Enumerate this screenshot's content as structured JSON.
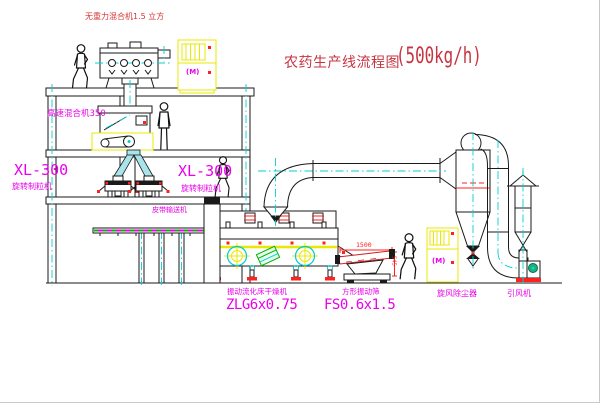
{
  "title": {
    "name": "农药生产线流程图",
    "capacity": "(500kg/h)"
  },
  "equipment_labels": {
    "gravity_mixer": "无重力混合机1.5 立方",
    "high_speed_mixer": "高速混合机350",
    "granulator_left": {
      "model": "XL-300",
      "name": "旋转制粒机"
    },
    "granulator_right": {
      "model": "XL-300",
      "name": "旋转制粒机"
    },
    "belt_conveyor": "皮带输送机",
    "fluid_bed_dryer": {
      "name": "振动流化床干燥机",
      "model": "ZLG6x0.75"
    },
    "vibrating_sieve": {
      "name": "方形振动筛",
      "model": "FS0.6x1.5"
    },
    "cyclone": "旋风除尘器",
    "induced_draft_fan": "引风机"
  },
  "dimensions": {
    "sieve_length": "1500",
    "sieve_height": "545"
  },
  "control_cabinet": {
    "motor_symbol": "(M)"
  },
  "colors": {
    "line_black": "#1a1a1a",
    "machine_yellow": "#e8e800",
    "centerline_cyan": "#00d0d0",
    "label_magenta": "#ea00ea",
    "title_red": "#c73440",
    "detail_red": "#ff2020",
    "detail_green": "#00b400"
  }
}
